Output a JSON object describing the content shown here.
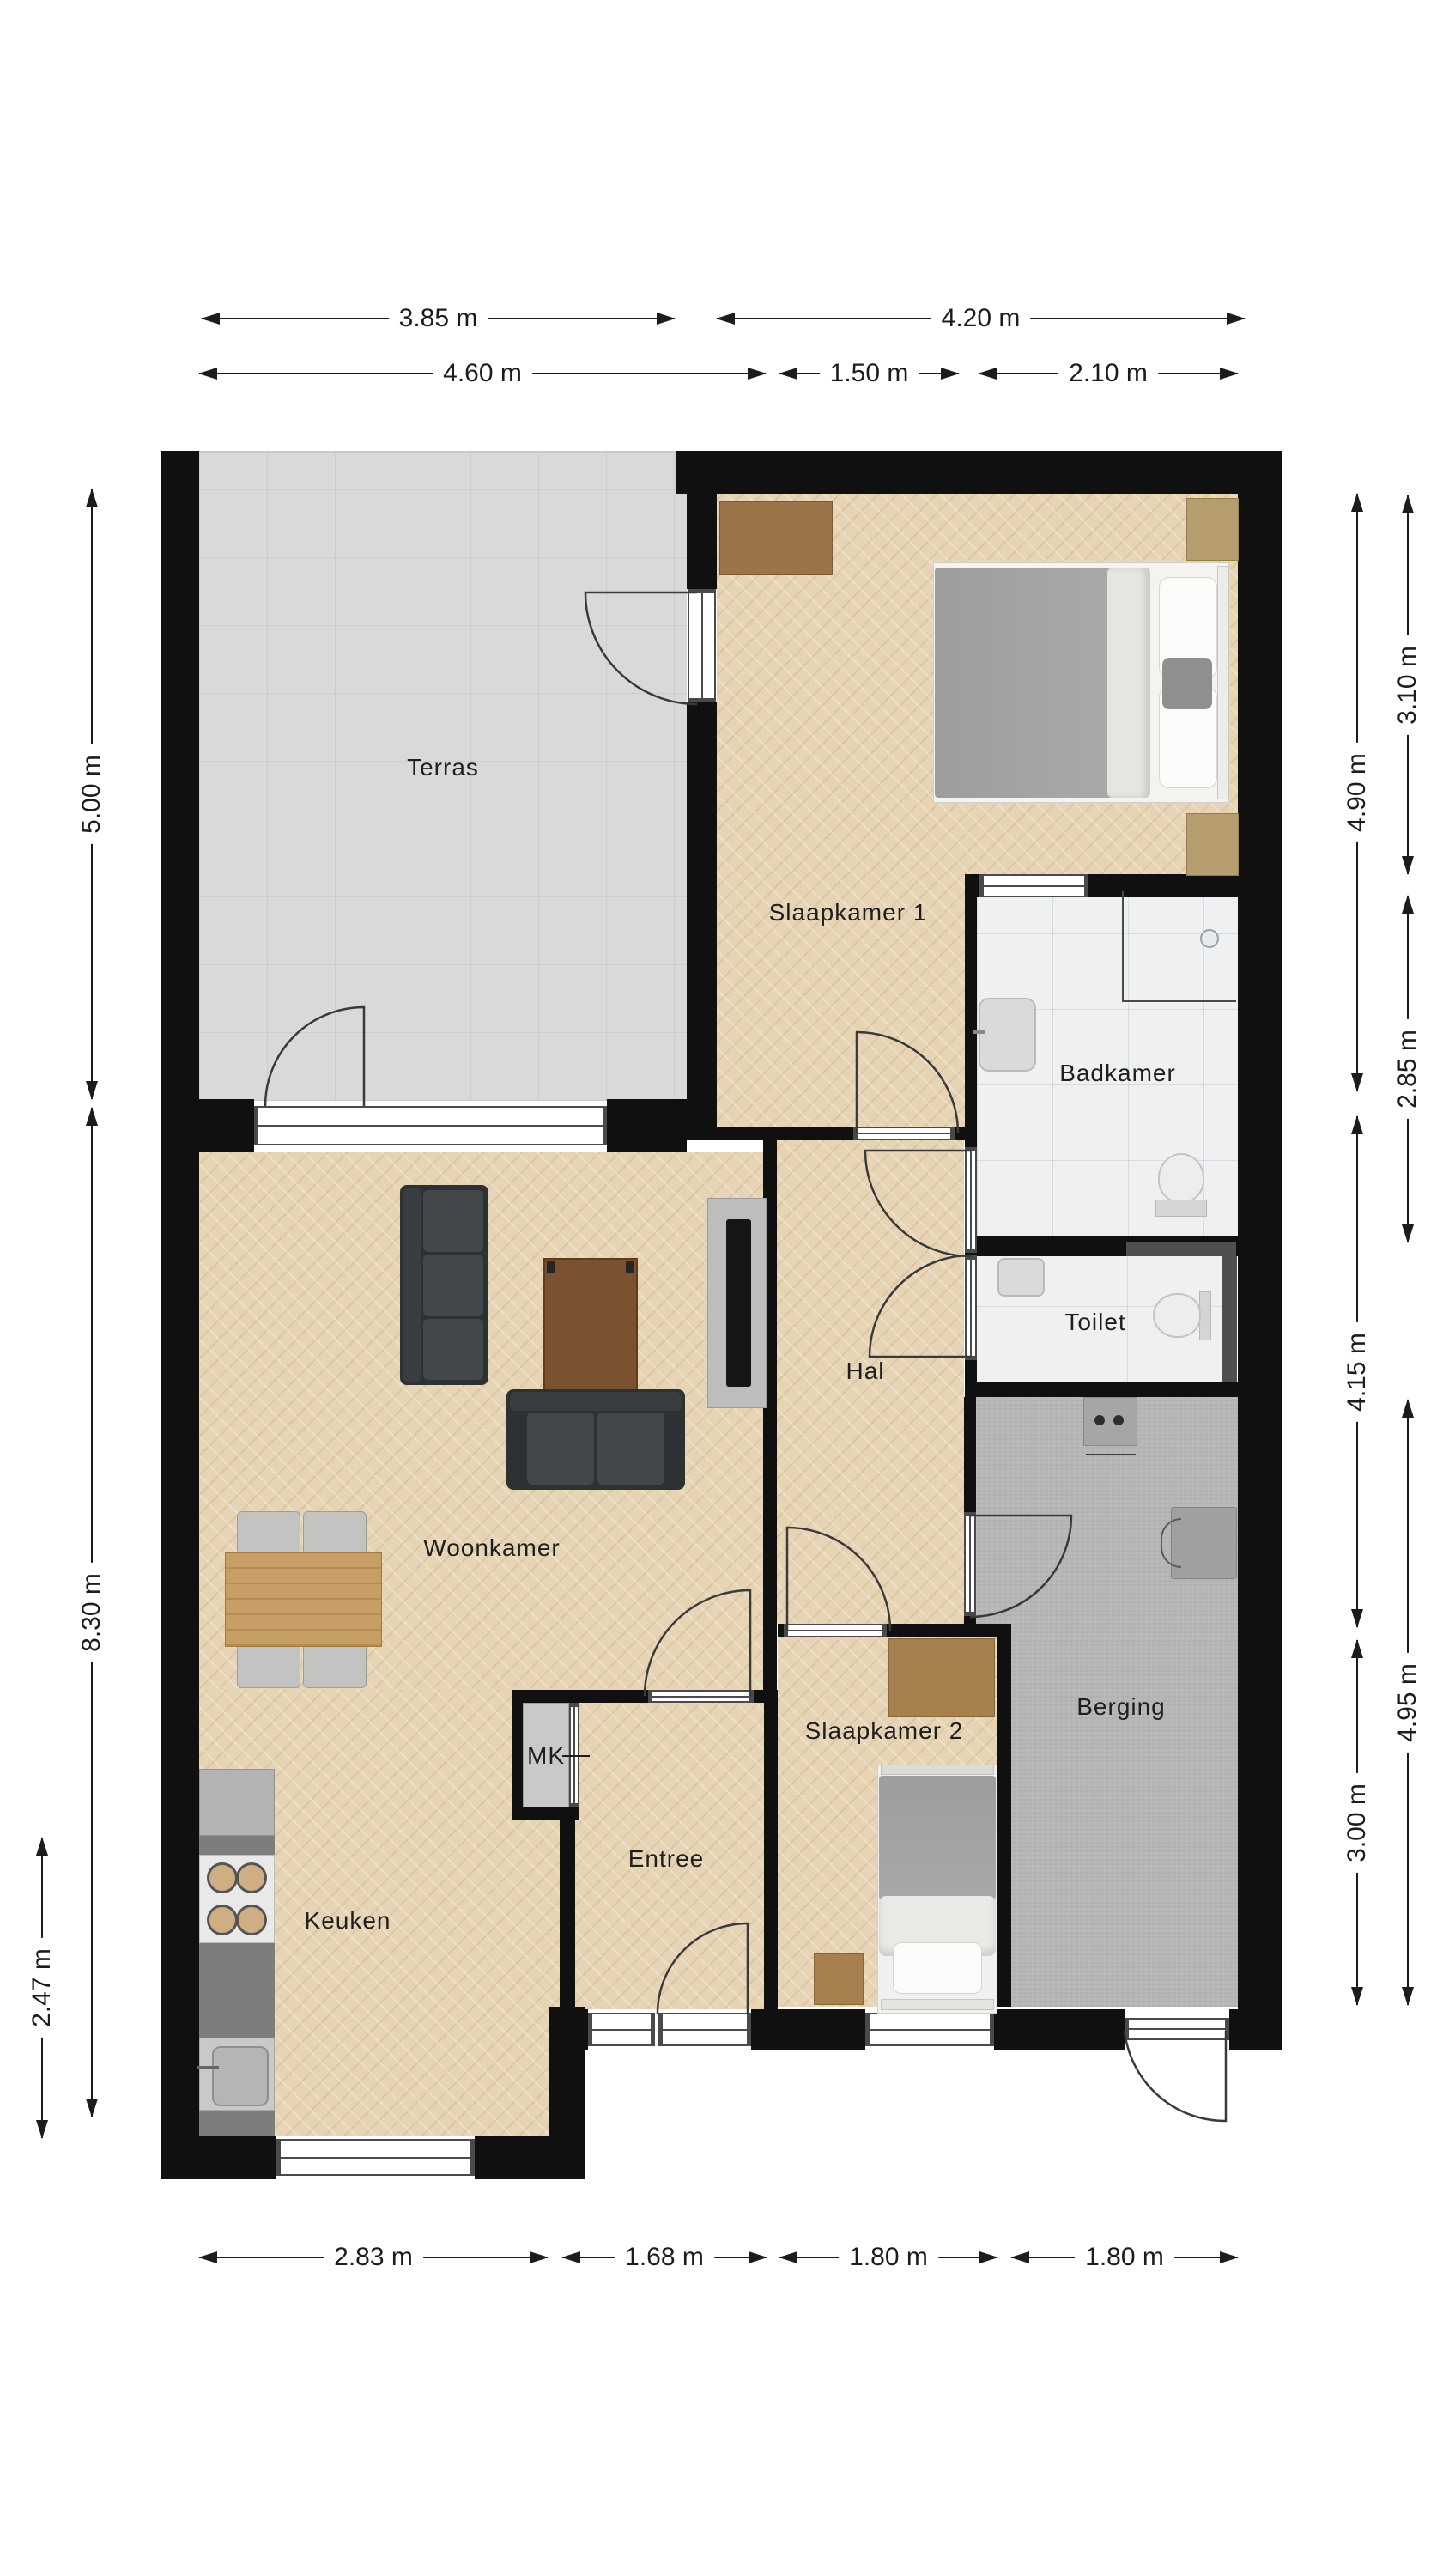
{
  "title": "Floor plan (plattegrond appartement)",
  "rooms": {
    "terras": "Terras",
    "slaapkamer1": "Slaapkamer 1",
    "badkamer": "Badkamer",
    "toilet": "Toilet",
    "hal": "Hal",
    "woonkamer": "Woonkamer",
    "berging": "Berging",
    "slaapkamer2": "Slaapkamer 2",
    "entree": "Entree",
    "keuken": "Keuken",
    "mk": "MK"
  },
  "dims": {
    "top_outer": [
      "3.85 m",
      "4.20 m"
    ],
    "top_inner": [
      "4.60 m",
      "1.50 m",
      "2.10 m"
    ],
    "left": [
      "5.00 m",
      "8.30 m",
      "2.47 m"
    ],
    "right_inner": [
      "4.90 m",
      "4.15 m",
      "3.00 m"
    ],
    "right_outer": [
      "3.10 m",
      "2.85 m",
      "4.95 m"
    ],
    "bottom": [
      "2.83 m",
      "1.68 m",
      "1.80 m",
      "1.80 m"
    ]
  },
  "colors": {
    "wall": "#101010",
    "parquet_floor": "#e6d4b4",
    "terrace_tile": "#d9d9d9",
    "bathroom_tile": "#eef0f2",
    "storage_concrete": "#b7b7b7",
    "sofa_dark": "#36393c",
    "wood_coffee_table": "#7a5230",
    "wood_desk": "#a87f4f",
    "wood_dining_table": "#c79e66",
    "text": "#1c1c1c"
  }
}
